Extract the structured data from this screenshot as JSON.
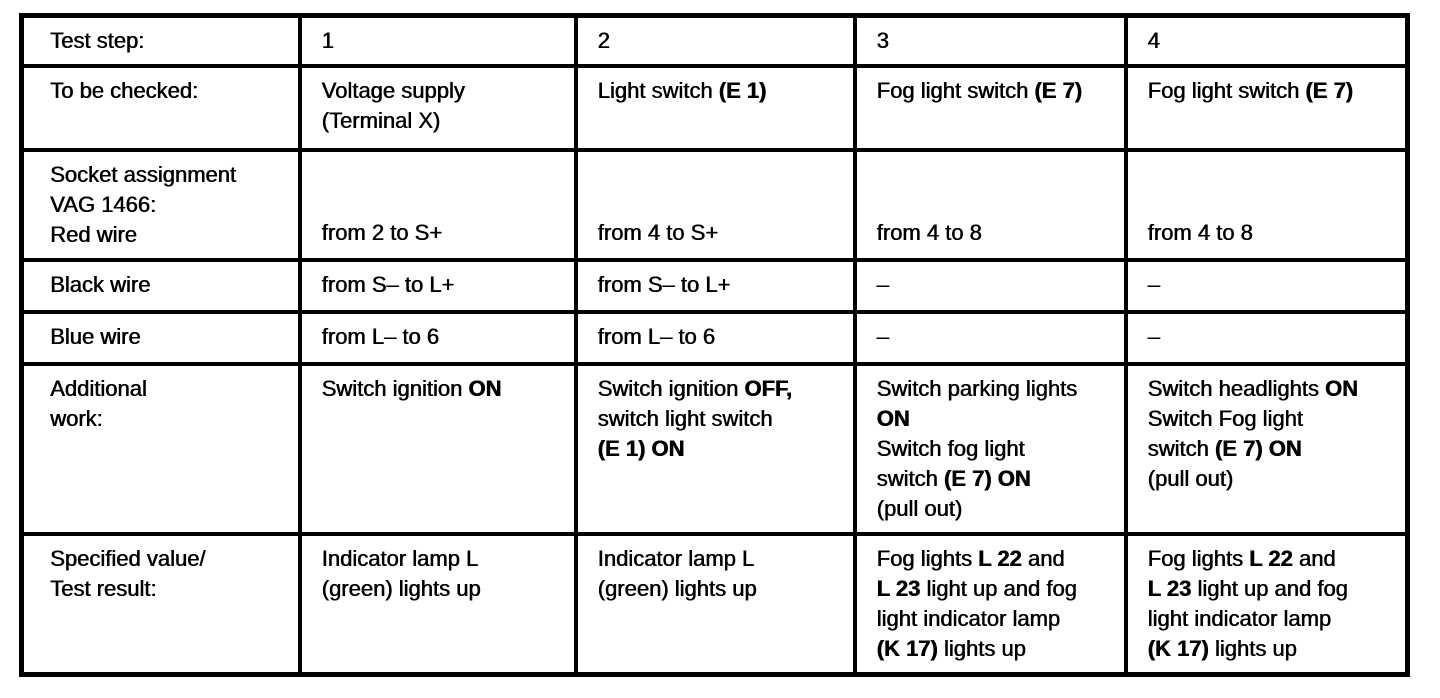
{
  "page": {
    "kind": "scanned test procedure table",
    "colors": {
      "paper": "#ffffff",
      "ink": "#000000"
    }
  },
  "table": {
    "title": "Test step table",
    "columns": [
      "row-label",
      "step-1",
      "step-2",
      "step-3",
      "step-4"
    ],
    "rows": [
      {
        "name": "test-step",
        "cells": [
          {
            "lines": [
              [
                {
                  "t": "Test step:"
                }
              ]
            ]
          },
          {
            "lines": [
              [
                {
                  "t": "1"
                }
              ]
            ]
          },
          {
            "lines": [
              [
                {
                  "t": "2"
                }
              ]
            ]
          },
          {
            "lines": [
              [
                {
                  "t": "3"
                }
              ]
            ]
          },
          {
            "lines": [
              [
                {
                  "t": "4"
                }
              ]
            ]
          }
        ]
      },
      {
        "name": "to-be-checked",
        "cells": [
          {
            "lines": [
              [
                {
                  "t": "To be checked:"
                }
              ]
            ]
          },
          {
            "lines": [
              [
                {
                  "t": "Voltage supply"
                }
              ],
              [
                {
                  "t": "(Terminal X)"
                }
              ]
            ]
          },
          {
            "lines": [
              [
                {
                  "t": "Light switch "
                },
                {
                  "t": "(E 1)",
                  "b": true
                }
              ]
            ]
          },
          {
            "lines": [
              [
                {
                  "t": "Fog light switch "
                },
                {
                  "t": "(E 7)",
                  "b": true
                }
              ]
            ]
          },
          {
            "lines": [
              [
                {
                  "t": "Fog light switch "
                },
                {
                  "t": "(E 7)",
                  "b": true
                }
              ]
            ]
          }
        ]
      },
      {
        "name": "socket-assignment-red-wire",
        "cells": [
          {
            "lines": [
              [
                {
                  "t": "Socket assignment"
                }
              ],
              [
                {
                  "t": "VAG 1466:"
                }
              ],
              [
                {
                  "t": "Red wire"
                }
              ]
            ]
          },
          {
            "valign": "bottom",
            "lines": [
              [
                {
                  "t": "from 2 to S+"
                }
              ]
            ]
          },
          {
            "valign": "bottom",
            "lines": [
              [
                {
                  "t": "from 4 to S+"
                }
              ]
            ]
          },
          {
            "valign": "bottom",
            "lines": [
              [
                {
                  "t": "from 4 to 8"
                }
              ]
            ]
          },
          {
            "valign": "bottom",
            "lines": [
              [
                {
                  "t": "from 4 to 8"
                }
              ]
            ]
          }
        ]
      },
      {
        "name": "black-wire",
        "cells": [
          {
            "lines": [
              [
                {
                  "t": "Black wire"
                }
              ]
            ]
          },
          {
            "lines": [
              [
                {
                  "t": "from S– to L+"
                }
              ]
            ]
          },
          {
            "lines": [
              [
                {
                  "t": "from S– to L+"
                }
              ]
            ]
          },
          {
            "lines": [
              [
                {
                  "t": "–"
                }
              ]
            ]
          },
          {
            "lines": [
              [
                {
                  "t": "–"
                }
              ]
            ]
          }
        ]
      },
      {
        "name": "blue-wire",
        "cells": [
          {
            "lines": [
              [
                {
                  "t": "Blue wire"
                }
              ]
            ]
          },
          {
            "lines": [
              [
                {
                  "t": "from L– to 6"
                }
              ]
            ]
          },
          {
            "lines": [
              [
                {
                  "t": "from L– to 6"
                }
              ]
            ]
          },
          {
            "lines": [
              [
                {
                  "t": "–"
                }
              ]
            ]
          },
          {
            "lines": [
              [
                {
                  "t": "–"
                }
              ]
            ]
          }
        ]
      },
      {
        "name": "additional-work",
        "cells": [
          {
            "lines": [
              [
                {
                  "t": "Additional"
                }
              ],
              [
                {
                  "t": "work:"
                }
              ]
            ]
          },
          {
            "lines": [
              [
                {
                  "t": "Switch ignition "
                },
                {
                  "t": "ON",
                  "b": true
                }
              ]
            ]
          },
          {
            "lines": [
              [
                {
                  "t": "Switch ignition "
                },
                {
                  "t": "OFF,",
                  "b": true
                }
              ],
              [
                {
                  "t": "switch light switch"
                }
              ],
              [
                {
                  "t": "(E 1) ON",
                  "b": true
                }
              ]
            ]
          },
          {
            "lines": [
              [
                {
                  "t": "Switch parking lights"
                }
              ],
              [
                {
                  "t": "ON",
                  "b": true
                }
              ],
              [
                {
                  "t": "Switch fog light"
                }
              ],
              [
                {
                  "t": "switch "
                },
                {
                  "t": "(E 7) ON",
                  "b": true
                }
              ],
              [
                {
                  "t": "(pull out)"
                }
              ]
            ]
          },
          {
            "lines": [
              [
                {
                  "t": "Switch headlights "
                },
                {
                  "t": "ON",
                  "b": true
                }
              ],
              [
                {
                  "t": "Switch Fog light"
                }
              ],
              [
                {
                  "t": "switch "
                },
                {
                  "t": "(E 7) ON",
                  "b": true
                }
              ],
              [
                {
                  "t": "(pull out)"
                }
              ]
            ]
          }
        ]
      },
      {
        "name": "specified-value-test-result",
        "cells": [
          {
            "lines": [
              [
                {
                  "t": "Specified value/"
                }
              ],
              [
                {
                  "t": "Test result:"
                }
              ]
            ]
          },
          {
            "lines": [
              [
                {
                  "t": "Indicator lamp L"
                }
              ],
              [
                {
                  "t": "(green) lights up"
                }
              ]
            ]
          },
          {
            "lines": [
              [
                {
                  "t": "Indicator lamp L"
                }
              ],
              [
                {
                  "t": "(green) lights up"
                }
              ]
            ]
          },
          {
            "lines": [
              [
                {
                  "t": "Fog lights "
                },
                {
                  "t": "L 22",
                  "b": true
                },
                {
                  "t": " and"
                }
              ],
              [
                {
                  "t": "L 23",
                  "b": true
                },
                {
                  "t": " light up and fog"
                }
              ],
              [
                {
                  "t": "light indicator lamp"
                }
              ],
              [
                {
                  "t": "(K 17)",
                  "b": true
                },
                {
                  "t": " lights up"
                }
              ]
            ]
          },
          {
            "lines": [
              [
                {
                  "t": "Fog lights "
                },
                {
                  "t": "L 22",
                  "b": true
                },
                {
                  "t": " and"
                }
              ],
              [
                {
                  "t": "L 23",
                  "b": true
                },
                {
                  "t": " light up and fog"
                }
              ],
              [
                {
                  "t": "light indicator lamp"
                }
              ],
              [
                {
                  "t": "(K 17)",
                  "b": true
                },
                {
                  "t": " lights up"
                }
              ]
            ]
          }
        ]
      }
    ]
  }
}
